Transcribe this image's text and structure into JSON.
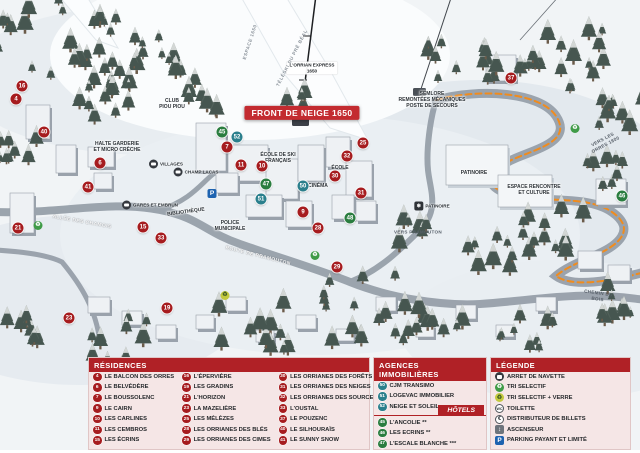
{
  "colors": {
    "residence_badge": "#a61c1f",
    "agency_badge": "#2a7f8c",
    "hotel_badge": "#2a7d3f",
    "header_bar": "#b02126",
    "banner_red": "#c32b30",
    "panel_pink": "#f5e6e6",
    "route_orange": "#f08c1e",
    "parking_blue": "#1e63b0",
    "bus_dark": "#35393f",
    "recycle_green": "#3f9b47",
    "recycle_glass_yellow": "#c3c93e"
  },
  "map": {
    "labels": [
      {
        "text": "FRONT DE NEIGE 1650",
        "x": 302,
        "y": 113,
        "kind": "banner",
        "rot": 0
      },
      {
        "text": "L'ORRIAN EXPRESS\n1650",
        "x": 312,
        "y": 68,
        "kind": "chip",
        "rot": 0
      },
      {
        "text": "SEMLORE\nREMONTÉES MÉCANIQUES\nPOSTE DE SECOURS",
        "x": 432,
        "y": 100,
        "kind": "tiny",
        "rot": 0
      },
      {
        "text": "PATINOIRE",
        "x": 474,
        "y": 173,
        "kind": "tiny",
        "rot": 0
      },
      {
        "text": "ESPACE RENCONTRE\nET CULTURE",
        "x": 534,
        "y": 190,
        "kind": "tiny",
        "rot": 0
      },
      {
        "text": "ROUTE DE PRAMOUTON",
        "x": 258,
        "y": 256,
        "kind": "road",
        "rot": 14
      },
      {
        "text": "ALLÉE DES CHAMOIS",
        "x": 82,
        "y": 222,
        "kind": "road",
        "rot": 10
      },
      {
        "text": "VERS LES ORRES 1800",
        "x": 604,
        "y": 142,
        "kind": "roaddark",
        "rot": -28
      },
      {
        "text": "VERS PRAMOUTON",
        "x": 418,
        "y": 232,
        "kind": "roaddark",
        "rot": 0
      },
      {
        "text": "CHEMIN DU BOIS",
        "x": 598,
        "y": 296,
        "kind": "roaddark",
        "rot": 8
      },
      {
        "text": "BIBLIOTHÈQUE",
        "x": 186,
        "y": 212,
        "kind": "tiny",
        "rot": -8
      },
      {
        "text": "POLICE\nMUNICIPALE",
        "x": 230,
        "y": 226,
        "kind": "tiny",
        "rot": 0
      },
      {
        "text": "HALTE GARDERIE\nET MICRO CRÈCHE",
        "x": 117,
        "y": 147,
        "kind": "tiny",
        "rot": 0
      },
      {
        "text": "CLUB\nPIOU PIOU",
        "x": 172,
        "y": 104,
        "kind": "tiny",
        "rot": 0
      },
      {
        "text": "ÉCOLE DE SKI\nFRANÇAIS",
        "x": 278,
        "y": 158,
        "kind": "tiny",
        "rot": 0
      },
      {
        "text": "CINÉMA",
        "x": 318,
        "y": 186,
        "kind": "tiny",
        "rot": 0
      },
      {
        "text": "ÉCOLE",
        "x": 340,
        "y": 168,
        "kind": "tiny",
        "rot": 0
      },
      {
        "text": "ESPACE 1650",
        "x": 250,
        "y": 42,
        "kind": "slope",
        "rot": -72
      },
      {
        "text": "TÉLÉSKI DU PRÉ BÉAL",
        "x": 292,
        "y": 58,
        "kind": "slope",
        "rot": -63
      }
    ],
    "markers": [
      {
        "n": "16",
        "kind": "res",
        "x": 22,
        "y": 86
      },
      {
        "n": "4",
        "kind": "res",
        "x": 16,
        "y": 99
      },
      {
        "n": "40",
        "kind": "res",
        "x": 44,
        "y": 132
      },
      {
        "n": "6",
        "kind": "res",
        "x": 100,
        "y": 163
      },
      {
        "n": "41",
        "kind": "res",
        "x": 88,
        "y": 187
      },
      {
        "n": "21",
        "kind": "res",
        "x": 18,
        "y": 228
      },
      {
        "n": "15",
        "kind": "res",
        "x": 143,
        "y": 227
      },
      {
        "n": "33",
        "kind": "res",
        "x": 161,
        "y": 238
      },
      {
        "n": "23",
        "kind": "res",
        "x": 69,
        "y": 318
      },
      {
        "n": "19",
        "kind": "res",
        "x": 167,
        "y": 308
      },
      {
        "n": "7",
        "kind": "res",
        "x": 227,
        "y": 147
      },
      {
        "n": "11",
        "kind": "res",
        "x": 241,
        "y": 165
      },
      {
        "n": "10",
        "kind": "res",
        "x": 262,
        "y": 166
      },
      {
        "n": "9",
        "kind": "res",
        "x": 303,
        "y": 212
      },
      {
        "n": "25",
        "kind": "res",
        "x": 363,
        "y": 143
      },
      {
        "n": "32",
        "kind": "res",
        "x": 347,
        "y": 156
      },
      {
        "n": "30",
        "kind": "res",
        "x": 335,
        "y": 176
      },
      {
        "n": "31",
        "kind": "res",
        "x": 361,
        "y": 193
      },
      {
        "n": "28",
        "kind": "res",
        "x": 318,
        "y": 228
      },
      {
        "n": "29",
        "kind": "res",
        "x": 337,
        "y": 267
      },
      {
        "n": "37",
        "kind": "res",
        "x": 511,
        "y": 78
      },
      {
        "n": "50",
        "kind": "agency",
        "x": 303,
        "y": 186
      },
      {
        "n": "51",
        "kind": "agency",
        "x": 261,
        "y": 199
      },
      {
        "n": "52",
        "kind": "agency",
        "x": 237,
        "y": 137
      },
      {
        "n": "45",
        "kind": "hotel",
        "x": 222,
        "y": 132
      },
      {
        "n": "47",
        "kind": "hotel",
        "x": 266,
        "y": 184
      },
      {
        "n": "48",
        "kind": "hotel",
        "x": 350,
        "y": 218
      },
      {
        "n": "46",
        "kind": "hotel",
        "x": 622,
        "y": 196
      }
    ],
    "icons": [
      {
        "icon": "parking",
        "x": 212,
        "y": 191
      },
      {
        "icon": "recycle",
        "x": 38,
        "y": 222
      },
      {
        "icon": "recycle",
        "x": 575,
        "y": 125
      },
      {
        "icon": "recycle",
        "x": 315,
        "y": 252
      },
      {
        "icon": "recycle-glass",
        "x": 225,
        "y": 292
      }
    ],
    "busstops": [
      {
        "label": "VILLAGES",
        "x": 166,
        "y": 164
      },
      {
        "label": "GARES ET EMBRUN",
        "x": 150,
        "y": 205
      },
      {
        "label": "CHAMP LACAS",
        "x": 196,
        "y": 172
      }
    ],
    "facilities": [
      {
        "label": "PATINOIRE",
        "x": 432,
        "y": 206
      }
    ]
  },
  "panels": {
    "residences": {
      "title": "RÉSIDENCES",
      "columns": [
        [
          {
            "n": "4",
            "label": "LE BALCON DES ORRES"
          },
          {
            "n": "6",
            "label": "LE BELVÉDÈRE"
          },
          {
            "n": "7",
            "label": "LE BOUSSOLENC"
          },
          {
            "n": "9",
            "label": "LE CAIRN"
          },
          {
            "n": "10",
            "label": "LES CARLINES"
          },
          {
            "n": "11",
            "label": "LES CEMBROS"
          },
          {
            "n": "15",
            "label": "LES ÉCRINS"
          }
        ],
        [
          {
            "n": "16",
            "label": "L'ÉPERVIÈRE"
          },
          {
            "n": "19",
            "label": "LES GRADINS"
          },
          {
            "n": "21",
            "label": "L'HORIZON"
          },
          {
            "n": "23",
            "label": "LA MAZELIÈRE"
          },
          {
            "n": "25",
            "label": "LES MÉLÈZES"
          },
          {
            "n": "28",
            "label": "LES ORRIANES DES BLÉS"
          },
          {
            "n": "29",
            "label": "LES ORRIANES DES CIMES"
          }
        ],
        [
          {
            "n": "30",
            "label": "LES ORRIANES DES FORÊTS"
          },
          {
            "n": "31",
            "label": "LES ORRIANES DES NEIGES"
          },
          {
            "n": "32",
            "label": "LES ORRIANES DES SOURCES"
          },
          {
            "n": "33",
            "label": "L'OUSTAL"
          },
          {
            "n": "37",
            "label": "LE POUZENC"
          },
          {
            "n": "40",
            "label": "LE SILHOURAÏS"
          },
          {
            "n": "41",
            "label": "LE SUNNY SNOW"
          }
        ]
      ]
    },
    "agences": {
      "title": "AGENCES IMMOBILIÈRES",
      "items": [
        {
          "n": "50",
          "label": "CJM TRANSIMO"
        },
        {
          "n": "51",
          "label": "LOGEVAC IMMOBILIER"
        },
        {
          "n": "52",
          "label": "NEIGE ET SOLEIL"
        }
      ]
    },
    "hotels": {
      "title": "HÔTELS",
      "items": [
        {
          "n": "45",
          "label": "L'ANCOLIE **"
        },
        {
          "n": "46",
          "label": "LES ECRINS **"
        },
        {
          "n": "47",
          "label": "L'ESCALE BLANCHE ***"
        },
        {
          "n": "48",
          "label": "LES TRAPPEURS **"
        }
      ]
    },
    "legende": {
      "title": "LÉGENDE",
      "items": [
        {
          "icon": "bus",
          "label": "ARRET DE NAVETTE"
        },
        {
          "icon": "recycle",
          "label": "TRI SELECTIF"
        },
        {
          "icon": "recycle-glass",
          "label": "TRI SELECTIF + VERRE"
        },
        {
          "icon": "wc",
          "label": "TOILETTE"
        },
        {
          "icon": "euro",
          "label": "DISTRIBUTEUR DE BILLETS"
        },
        {
          "icon": "elevator",
          "label": "ASCENSEUR"
        },
        {
          "icon": "parking",
          "label": "PARKING PAYANT ET LIMITÉ"
        }
      ]
    }
  }
}
